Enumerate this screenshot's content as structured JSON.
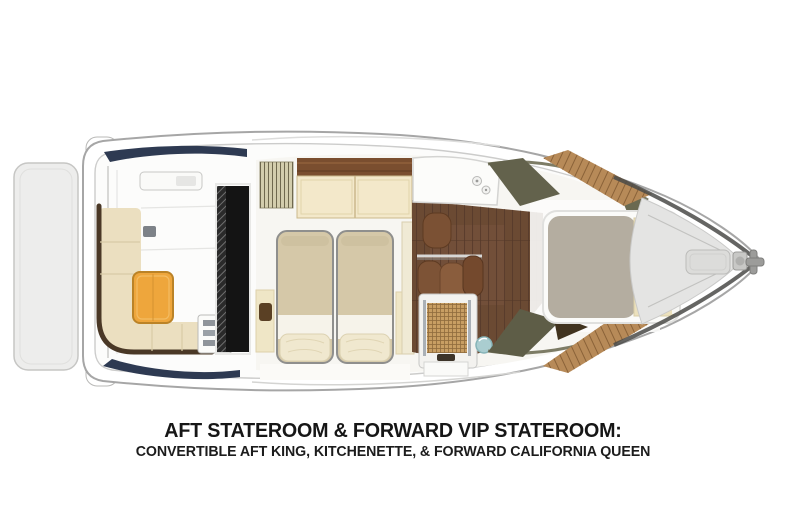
{
  "title_block": {
    "line1": "AFT STATEROOM & FORWARD VIP STATEROOM:",
    "line2": "CONVERTIBLE AFT KING, KITCHENETTE, & FORWARD CALIFORNIA QUEEN"
  },
  "diagram": {
    "type": "yacht-floorplan-top-view",
    "regions": [
      "swim-platform",
      "aft-cockpit-seating",
      "cockpit-table",
      "cabin-entry-door",
      "aft-stateroom-twin-beds",
      "kitchenette",
      "dinette-seating",
      "head-shower",
      "toilet",
      "sink",
      "forward-vip-stateroom-bed",
      "teak-side-decks",
      "bow-deck",
      "bow-hatch",
      "anchor-fitting"
    ]
  },
  "palette": {
    "accent_navy": "#2e3a52",
    "upholstery_cream": "#ebdfc0",
    "table_orange": "#eea63c",
    "mattress_tan": "#d5c8a8",
    "walnut_floor": "#6b4a33",
    "teak_trim": "#b78a58",
    "rattan_shower": "#c89e63",
    "sink_teal": "#aacdd0",
    "vip_mattress_gray": "#b4ada0",
    "hull_line": "#a6a6a6"
  }
}
